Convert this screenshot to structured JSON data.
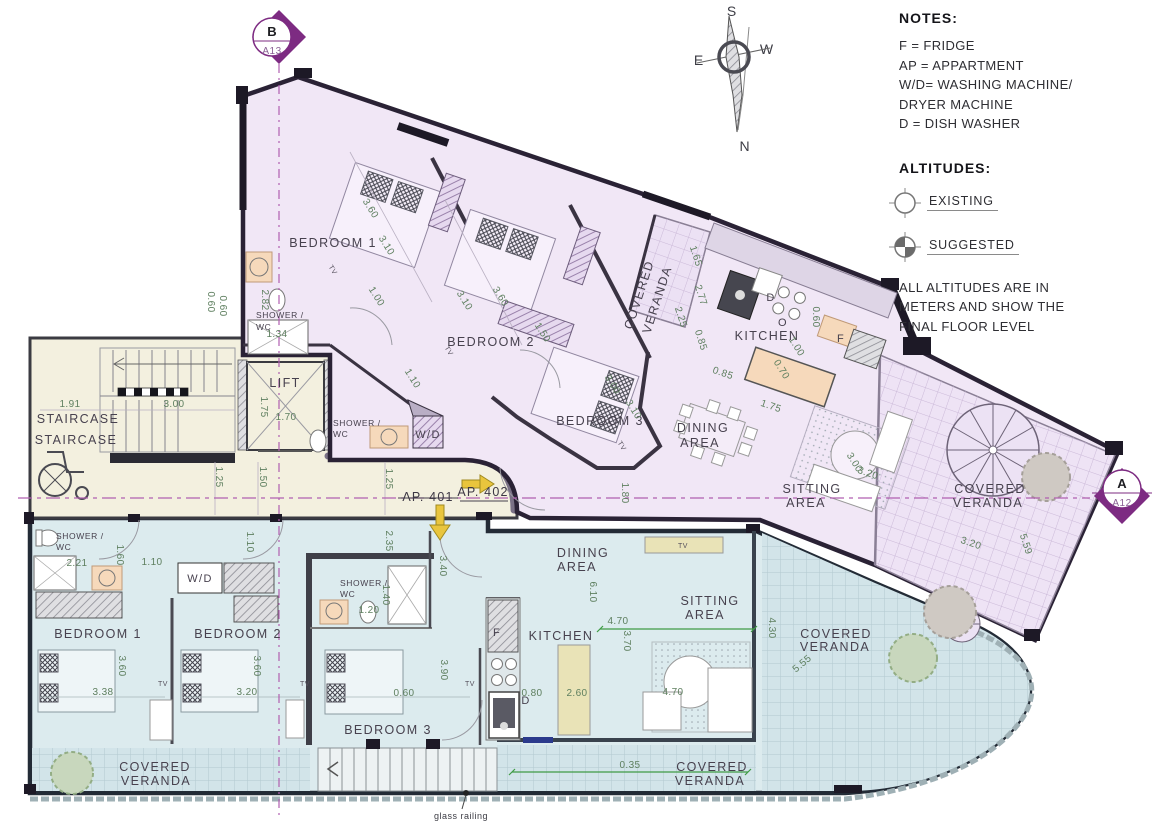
{
  "notes": {
    "title": "NOTES:",
    "lines": [
      "F = FRIDGE",
      "AP = APPARTMENT",
      "W/D= WASHING MACHINE/",
      "DRYER MACHINE",
      "D = DISH WASHER"
    ]
  },
  "altitudes": {
    "title": "ALTITUDES:",
    "existing": "EXISTING",
    "suggested": "SUGGESTED",
    "note": [
      "ALL ALTITUDES ARE IN",
      "METERS AND SHOW THE",
      "FINAL FLOOR LEVEL"
    ]
  },
  "compass": {
    "north": "N",
    "south": "S",
    "east": "E",
    "west": "W"
  },
  "markers": {
    "top": {
      "letter": "B",
      "sheet": "A13"
    },
    "right": {
      "letter": "A",
      "sheet": "A12"
    }
  },
  "apartments": {
    "lower": "AP. 401",
    "upper": "AP. 402"
  },
  "rooms": {
    "bedroom1": "BEDROOM 1",
    "bedroom2": "BEDROOM 2",
    "bedroom3": "BEDROOM 3",
    "kitchen": "KITCHEN",
    "dining_1": "DINING",
    "dining_2": "AREA",
    "sitting_1": "SITTING",
    "sitting_2": "AREA",
    "covered": "COVERED",
    "veranda": "VERANDA",
    "staircase": "STAIRCASE",
    "lift": "LIFT",
    "shower_1": "SHOWER /",
    "shower_2": "WC",
    "wd": "W/D",
    "tv": "TV"
  },
  "appliances": {
    "fridge": "F",
    "dishwasher": "D",
    "oven": "O"
  },
  "dims": {
    "upper": [
      "3.60",
      "3.10",
      "1.00",
      "2.82",
      "1.34",
      "3.10",
      "3.60",
      "1.50",
      "1.10",
      "3.00",
      "3.10",
      "1.80",
      "0.85",
      "0.85",
      "1.75",
      "0.60",
      "1.00",
      "0.70",
      "3.00",
      "3.20",
      "1.65",
      "2.77",
      "2.25",
      "3.20",
      "5.59",
      "0.60",
      "0.60"
    ],
    "lower": [
      "2.21",
      "1.60",
      "1.10",
      "1.10",
      "3.60",
      "3.38",
      "3.60",
      "3.20",
      "2.35",
      "1.20",
      "1.40",
      "3.40",
      "3.90",
      "0.60",
      "0.80",
      "2.60",
      "6.10",
      "4.70",
      "3.70",
      "4.70",
      "4.30",
      "5.55",
      "0.35"
    ],
    "core": [
      "1.91",
      "3.00",
      "1.75",
      "1.70",
      "1.25",
      "1.50",
      "1.25"
    ]
  },
  "annotations": {
    "glass_railing": "glass railing"
  },
  "colors": {
    "upper_fill": "#f1e7f6",
    "lower_fill": "#dcebee",
    "core_fill": "#f3f0df",
    "section": "#7d2b82",
    "dimension": "#5e7f5f",
    "arrow": "#e9c53d"
  }
}
